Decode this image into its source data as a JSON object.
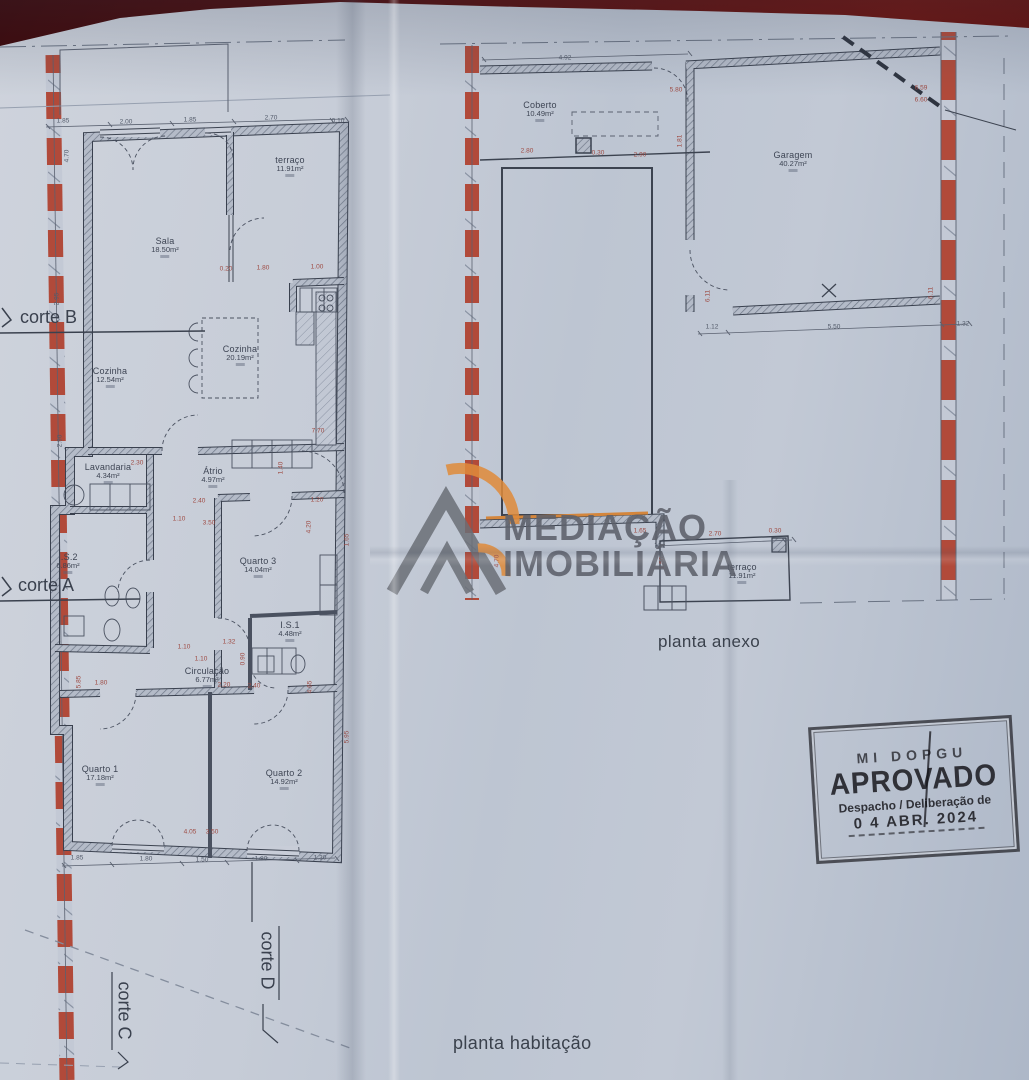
{
  "captions": {
    "left_plan": "planta habitação",
    "right_plan": "planta anexo"
  },
  "watermark": {
    "line1": "MEDIAÇÃO",
    "line2": "IMOBILIÁRIA"
  },
  "stamp": {
    "top": "MI  DOPGU",
    "title": "APROVADO",
    "subtitle": "Despacho / Deliberação de",
    "date": "0 4  ABR. 2024"
  },
  "cortes": [
    {
      "label": "corte B"
    },
    {
      "label": "corte A"
    },
    {
      "label": "corte D"
    },
    {
      "label": "corte C"
    }
  ],
  "room_labels": [
    {
      "name": "terraço",
      "area": "11.91m²",
      "x": 290,
      "y": 155
    },
    {
      "name": "Sala",
      "area": "18.50m²",
      "x": 165,
      "y": 236
    },
    {
      "name": "Cozinha",
      "area": "12.54m²",
      "x": 110,
      "y": 366
    },
    {
      "name": "Cozinha",
      "area": "20.19m²",
      "x": 240,
      "y": 344
    },
    {
      "name": "Lavandaria",
      "area": "4.34m²",
      "x": 108,
      "y": 462
    },
    {
      "name": "Átrio",
      "area": "4.97m²",
      "x": 213,
      "y": 466
    },
    {
      "name": "I.S.2",
      "area": "6.86m²",
      "x": 68,
      "y": 552
    },
    {
      "name": "Quarto 3",
      "area": "14.04m²",
      "x": 258,
      "y": 556
    },
    {
      "name": "I.S.1",
      "area": "4.48m²",
      "x": 290,
      "y": 620
    },
    {
      "name": "Circulação",
      "area": "6.77m²",
      "x": 207,
      "y": 666
    },
    {
      "name": "Quarto 1",
      "area": "17.18m²",
      "x": 100,
      "y": 764
    },
    {
      "name": "Quarto 2",
      "area": "14.92m²",
      "x": 284,
      "y": 768
    },
    {
      "name": "Coberto",
      "area": "10.49m²",
      "x": 540,
      "y": 100
    },
    {
      "name": "Garagem",
      "area": "40.27m²",
      "x": 793,
      "y": 150
    },
    {
      "name": "terraço",
      "area": "11.91m²",
      "x": 742,
      "y": 562
    }
  ],
  "dimensions": [
    {
      "t": "1.85",
      "x": 63,
      "y": 121,
      "c": "ink"
    },
    {
      "t": "2.00",
      "x": 126,
      "y": 122,
      "c": "ink"
    },
    {
      "t": "1.85",
      "x": 190,
      "y": 120,
      "c": "ink"
    },
    {
      "t": "2.70",
      "x": 271,
      "y": 118,
      "c": "ink"
    },
    {
      "t": "0.10",
      "x": 338,
      "y": 121,
      "c": "ink"
    },
    {
      "t": "4.70",
      "x": 67,
      "y": 156,
      "r": -90,
      "c": "ink"
    },
    {
      "t": "2.95",
      "x": 57,
      "y": 299,
      "r": -90,
      "c": "ink"
    },
    {
      "t": "2.90",
      "x": 60,
      "y": 441,
      "r": -90,
      "c": "ink"
    },
    {
      "t": "0.20",
      "x": 226,
      "y": 269
    },
    {
      "t": "1.80",
      "x": 263,
      "y": 268
    },
    {
      "t": "1.00",
      "x": 317,
      "y": 267
    },
    {
      "t": "7.70",
      "x": 318,
      "y": 431
    },
    {
      "t": "2.30",
      "x": 137,
      "y": 463
    },
    {
      "t": "2.40",
      "x": 199,
      "y": 501
    },
    {
      "t": "1.10",
      "x": 179,
      "y": 519
    },
    {
      "t": "3.50",
      "x": 209,
      "y": 523
    },
    {
      "t": "1.20",
      "x": 317,
      "y": 500
    },
    {
      "t": "4.20",
      "x": 309,
      "y": 527,
      "r": -90
    },
    {
      "t": "1.40",
      "x": 281,
      "y": 468,
      "r": -90
    },
    {
      "t": "1.65",
      "x": 347,
      "y": 540,
      "r": -90
    },
    {
      "t": "1.10",
      "x": 184,
      "y": 647
    },
    {
      "t": "1.32",
      "x": 229,
      "y": 642
    },
    {
      "t": "1.10",
      "x": 201,
      "y": 659
    },
    {
      "t": "0.90",
      "x": 243,
      "y": 659,
      "r": -90
    },
    {
      "t": "2.20",
      "x": 224,
      "y": 685
    },
    {
      "t": "2.40",
      "x": 254,
      "y": 686
    },
    {
      "t": "4.65",
      "x": 310,
      "y": 687,
      "r": -90
    },
    {
      "t": "5.85",
      "x": 79,
      "y": 682,
      "r": -90
    },
    {
      "t": "1.80",
      "x": 101,
      "y": 683
    },
    {
      "t": "5.95",
      "x": 347,
      "y": 737,
      "r": -90
    },
    {
      "t": "4.05",
      "x": 190,
      "y": 832
    },
    {
      "t": "3.50",
      "x": 212,
      "y": 832
    },
    {
      "t": "1.85",
      "x": 77,
      "y": 858,
      "c": "ink"
    },
    {
      "t": "1.80",
      "x": 146,
      "y": 859,
      "c": "ink"
    },
    {
      "t": "1.50",
      "x": 202,
      "y": 860,
      "c": "ink"
    },
    {
      "t": "1.80",
      "x": 261,
      "y": 859,
      "c": "ink"
    },
    {
      "t": "1.30",
      "x": 320,
      "y": 858,
      "c": "ink"
    },
    {
      "t": "4.92",
      "x": 565,
      "y": 58,
      "c": "ink"
    },
    {
      "t": "5.80",
      "x": 676,
      "y": 90
    },
    {
      "t": "2.80",
      "x": 527,
      "y": 151
    },
    {
      "t": "0.30",
      "x": 598,
      "y": 153
    },
    {
      "t": "2.90",
      "x": 640,
      "y": 155
    },
    {
      "t": "1.81",
      "x": 680,
      "y": 141,
      "r": -90
    },
    {
      "t": "6.59",
      "x": 921,
      "y": 88
    },
    {
      "t": "6.60",
      "x": 921,
      "y": 100
    },
    {
      "t": "6.11",
      "x": 708,
      "y": 296,
      "r": -90
    },
    {
      "t": "6.11",
      "x": 931,
      "y": 293,
      "r": -90
    },
    {
      "t": "1.12",
      "x": 712,
      "y": 327,
      "c": "ink"
    },
    {
      "t": "5.50",
      "x": 834,
      "y": 327,
      "c": "ink"
    },
    {
      "t": "1.32",
      "x": 963,
      "y": 324,
      "c": "ink"
    },
    {
      "t": "1.65",
      "x": 640,
      "y": 531
    },
    {
      "t": "2.70",
      "x": 715,
      "y": 534
    },
    {
      "t": "0.30",
      "x": 775,
      "y": 531
    },
    {
      "t": "4.70",
      "x": 497,
      "y": 561,
      "r": -90
    },
    {
      "t": "1.50",
      "x": 662,
      "y": 563,
      "r": -90
    }
  ],
  "colors": {
    "paper": "#c6ccd7",
    "ink": "#3c4350",
    "dimension_red": "#9e4a42",
    "boundary_red": "#b14a3a",
    "stamp_ink": "#26262c",
    "watermark_gray": "#5c606a",
    "watermark_orange": "#e08b3a",
    "highlight_orange": "#d4863c"
  }
}
